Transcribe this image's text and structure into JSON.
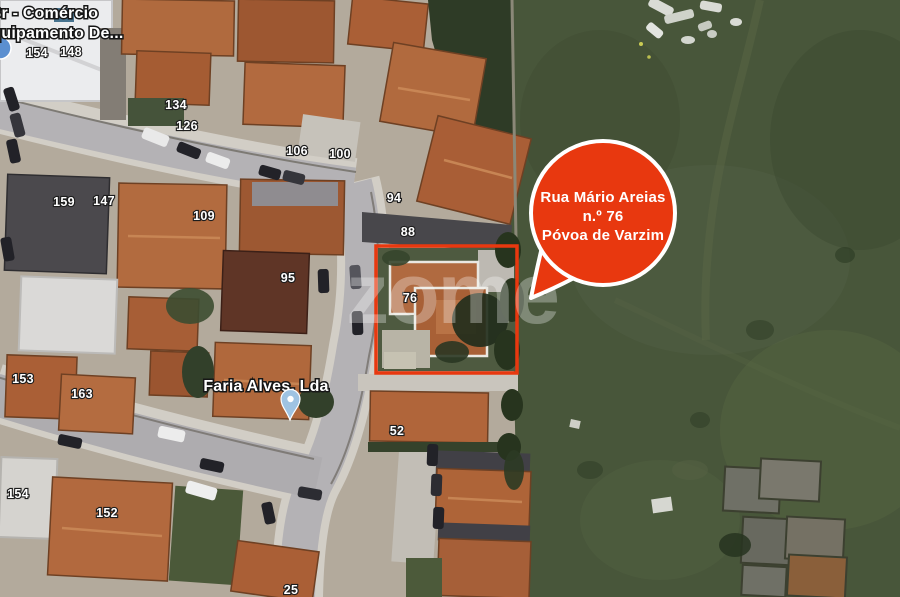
{
  "watermark": {
    "text": "zome"
  },
  "callout": {
    "line1": "Rua Mário Areias",
    "line2": "n.º 76",
    "line3": "Póvoa de Varzim",
    "color": "#e8380f",
    "text_color": "#ffffff"
  },
  "highlight": {
    "parcel_number": "76",
    "border_color": "#e8380f"
  },
  "pois": {
    "comercio": {
      "line1": "Br - Comércio",
      "line2": "Equipamento De..."
    },
    "faria": {
      "label": "Faria Alves, Lda",
      "marker_color": "#9fc3e2"
    }
  },
  "house_numbers": [
    "154",
    "148",
    "134",
    "126",
    "106",
    "100",
    "94",
    "88",
    "159",
    "147",
    "109",
    "95",
    "76",
    "153",
    "163",
    "52",
    "154",
    "152",
    "25"
  ]
}
